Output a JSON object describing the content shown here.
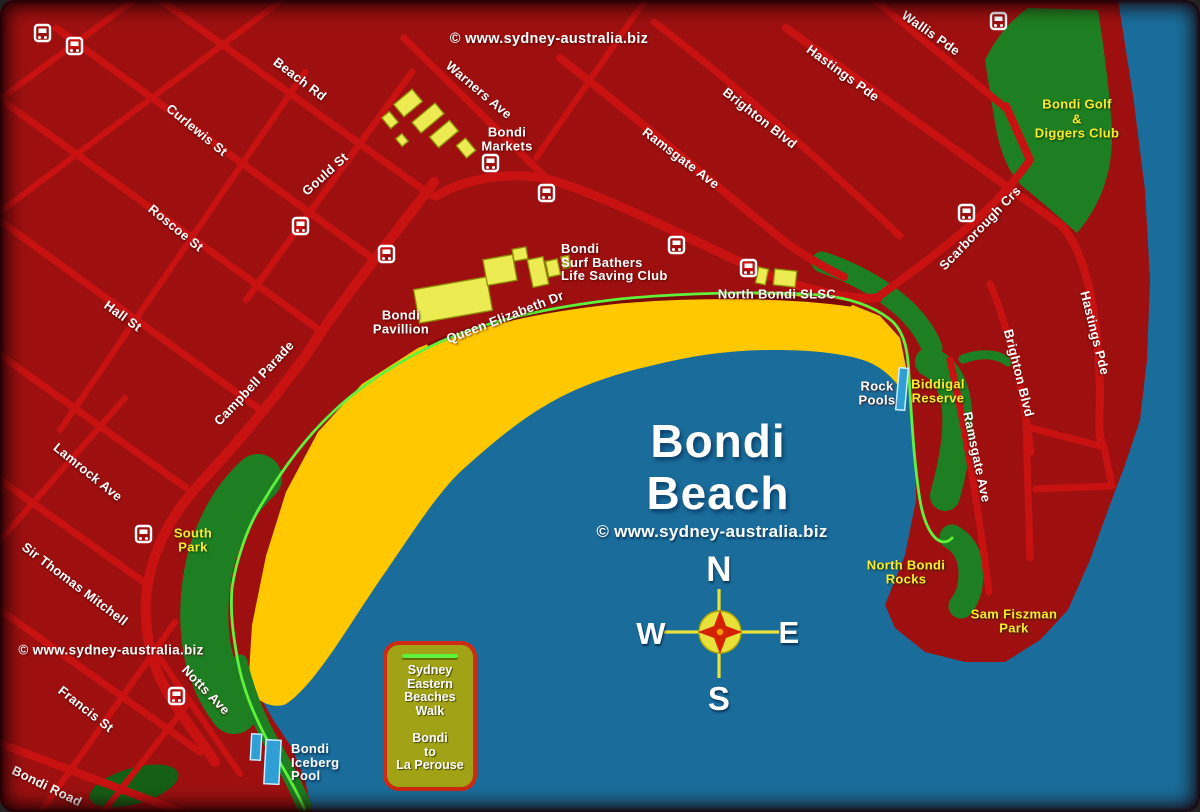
{
  "title": {
    "line1": "Bondi",
    "line2": "Beach"
  },
  "copyright": "© www.sydney-australia.biz",
  "compass": {
    "north": "N",
    "south": "S",
    "east": "E",
    "west": "W"
  },
  "streets": {
    "beach_rd": "Beach Rd",
    "curlewis_st": "Curlewis St",
    "roscoe_st": "Roscoe St",
    "gould_st": "Gould St",
    "hall_st": "Hall St",
    "campbell_parade": "Campbell Parade",
    "lamrock_ave": "Lamrock Ave",
    "sir_thomas_mitchell": "Sir Thomas Mitchell",
    "francis_st": "Francis St",
    "bondi_road": "Bondi Road",
    "notts_ave": "Notts Ave",
    "warners_ave": "Warners Ave",
    "ramsgate_ave_top": "Ramsgate Ave",
    "brighton_blvd_top": "Brighton Blvd",
    "hastings_pde_top": "Hastings Pde",
    "wallis_pde": "Wallis Pde",
    "scarborough_crs": "Scarborough Crs",
    "brighton_blvd_east": "Brighton Blvd",
    "hastings_pde_east": "Hastings Pde",
    "ramsgate_ave_east": "Ramsgate Ave",
    "queen_elizabeth_dr": "Queen Elizabeth Dr"
  },
  "places": {
    "bondi_markets": {
      "line1": "Bondi",
      "line2": "Markets"
    },
    "surf_bathers": {
      "line1": "Bondi",
      "line2": "Surf Bathers",
      "line3": "Life Saving Club"
    },
    "north_bondi_slsc": "North Bondi SLSC",
    "bondi_pavillion": {
      "line1": "Bondi",
      "line2": "Pavillion"
    },
    "rock_pools": {
      "line1": "Rock",
      "line2": "Pools"
    },
    "bondi_iceberg": {
      "line1": "Bondi",
      "line2": "Iceberg",
      "line3": "Pool"
    },
    "bondi_golf": {
      "line1": "Bondi Golf",
      "line2": "&",
      "line3": "Diggers Club"
    },
    "south_park": {
      "line1": "South",
      "line2": "Park"
    },
    "biddigal_reserve": {
      "line1": "Biddigal",
      "line2": "Reserve"
    },
    "north_bondi_rocks": {
      "line1": "North Bondi",
      "line2": "Rocks"
    },
    "sam_fiszman": {
      "line1": "Sam Fiszman",
      "line2": "Park"
    }
  },
  "legend": {
    "walk": {
      "line1": "Sydney",
      "line2": "Eastern",
      "line3": "Beaches",
      "line4": "Walk"
    },
    "route": {
      "line1": "Bondi",
      "line2": "to",
      "line3": "La Perouse"
    }
  },
  "icons": {
    "bus_stop": "bus-stop-icon",
    "rock_pool_marker": "rock-pool-marker",
    "iceberg_pool_marker": "iceberg-pool-marker",
    "compass_rose": "compass-rose-icon"
  },
  "colors": {
    "land": "#9e1010",
    "road": "#c81212",
    "roaddark": "#7c0a0a",
    "water": "#1a6d9b",
    "sand": "#ffc800",
    "park": "#1e7f22",
    "parkdark": "#156015",
    "building": "#ecec52",
    "buildingedge": "#8f8f06",
    "path": "#5ff23a",
    "pool": "#2f9fd6",
    "legendbg": "#a1a215",
    "legendborder": "#cf2a12",
    "labelyellow": "#ffe92e",
    "compassgold": "#e7e13a",
    "compassstar": "#d42200"
  }
}
